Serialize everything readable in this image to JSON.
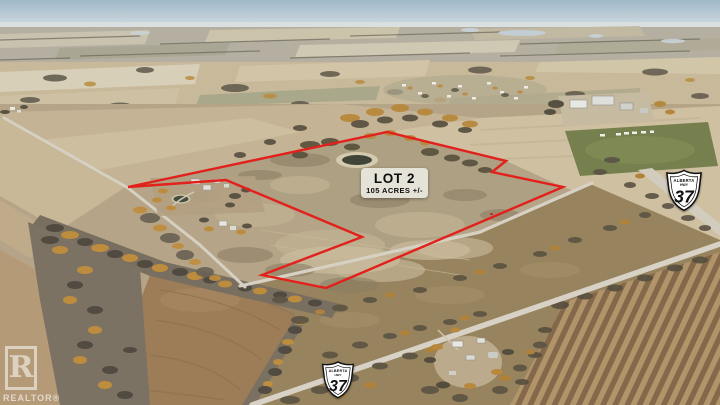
{
  "scene": {
    "description": "Oblique aerial drone photo of autumn prairie farmland with a parcel for sale outlined in red"
  },
  "boundary": {
    "color": "#e2211c",
    "points": "128,187 387,132 506,161 492,172 563,187 326,288 262,275 362,237 226,180"
  },
  "lot_label": {
    "title": "LOT 2",
    "subtitle": "105 ACRES +/-",
    "bg_color": "#e9e7e0",
    "text_color": "#0d0d0d"
  },
  "highway_shield": {
    "province": "ALBERTA",
    "road_type": "HWY",
    "number": "37",
    "fill": "#ffffff",
    "border": "#111111"
  },
  "watermark": {
    "logo_letter": "R",
    "label": "REALTOR®"
  },
  "colors": {
    "sky": "#a9bfcc",
    "field_tan": "#c9bb9d",
    "scrub": "#97835e",
    "road": "#d7d1c4",
    "trees_gold": "#bb8c3e",
    "trees_dark": "#564f3f"
  }
}
